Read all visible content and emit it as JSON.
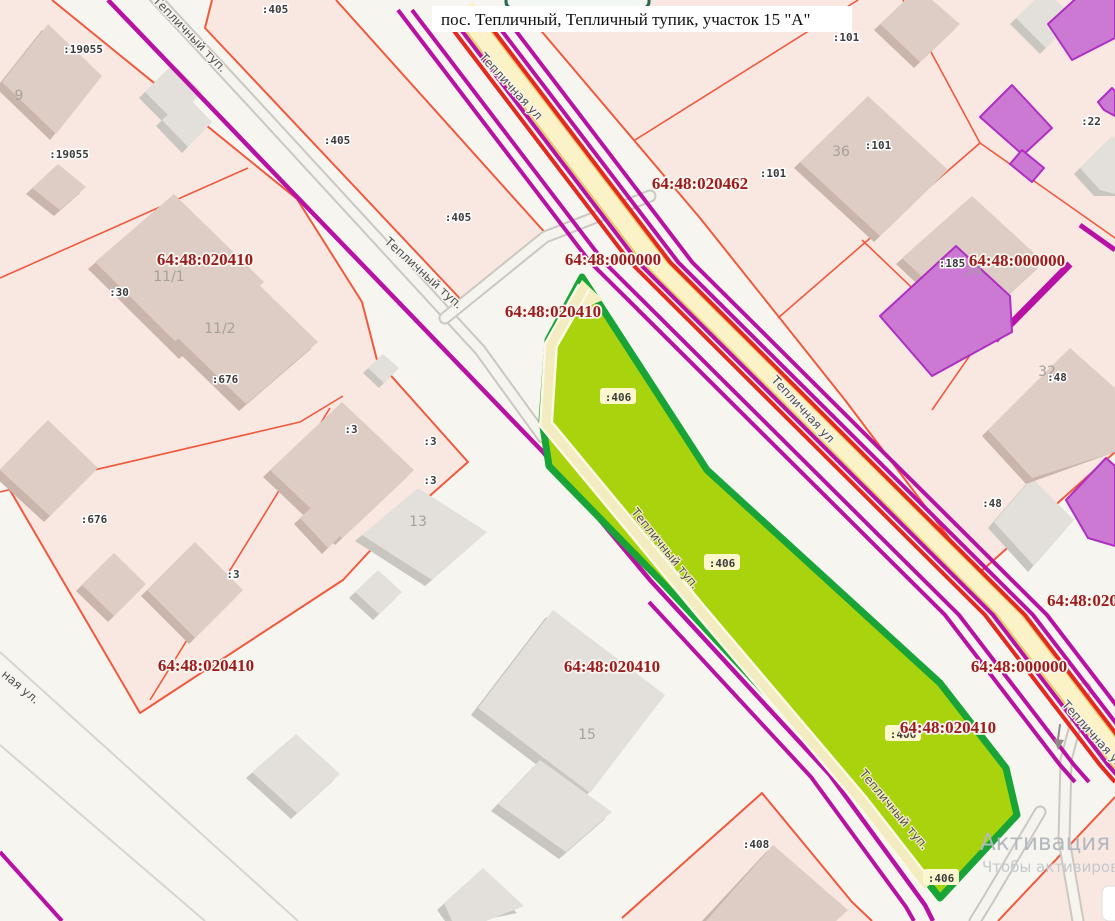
{
  "app": {
    "type": "public-cadastral-map"
  },
  "balloon": {
    "title": "пос. Тепличный, Тепличный тупик, участок 15 \"А\""
  },
  "watermark": {
    "line1": "Активация Win",
    "line2": "Чтобы активироват"
  },
  "colors": {
    "background": "#f7f5f0",
    "parcel_fill": "#f9e8e2",
    "parcel_border": "#f0593c",
    "quarter_label": "#9d1b1b",
    "road_magenta": "#b712a3",
    "road_red": "#e42a20",
    "road_yellow": "#fcf2c8",
    "selected_fill": "#a9d30d",
    "selected_border": "#18a437",
    "building_gray": "#e3e0dc",
    "building_brown": "#decdc5",
    "building_magenta": "#cb79d3"
  },
  "selected_parcel": {
    "number": ":406",
    "street": "Тепличный туп."
  },
  "quarter_labels": [
    {
      "t": "64:48:020410",
      "x": 205,
      "y": 265
    },
    {
      "t": "64:48:000000",
      "x": 613,
      "y": 265
    },
    {
      "t": "64:48:020410",
      "x": 553,
      "y": 317
    },
    {
      "t": "64:48:020462",
      "x": 700,
      "y": 189
    },
    {
      "t": "64:48:000000",
      "x": 1017,
      "y": 266
    },
    {
      "t": "64:48:020410",
      "x": 206,
      "y": 671
    },
    {
      "t": "64:48:020410",
      "x": 612,
      "y": 672
    },
    {
      "t": "64:48:000000",
      "x": 1019,
      "y": 672
    },
    {
      "t": "64:48:020410",
      "x": 948,
      "y": 733
    },
    {
      "t": "64:48:020",
      "x": 1047,
      "y": 606
    }
  ],
  "parcel_labels": [
    {
      "t": ":19055",
      "x": 83,
      "y": 53
    },
    {
      "t": ":19055",
      "x": 69,
      "y": 158
    },
    {
      "t": ":405",
      "x": 275,
      "y": 13
    },
    {
      "t": ":405",
      "x": 337,
      "y": 144
    },
    {
      "t": ":405",
      "x": 458,
      "y": 221
    },
    {
      "t": ":30",
      "x": 119,
      "y": 296
    },
    {
      "t": ":676",
      "x": 225,
      "y": 383
    },
    {
      "t": ":676",
      "x": 94,
      "y": 523
    },
    {
      "t": ":3",
      "x": 351,
      "y": 433
    },
    {
      "t": ":3",
      "x": 430,
      "y": 445
    },
    {
      "t": ":3",
      "x": 430,
      "y": 484
    },
    {
      "t": ":3",
      "x": 233,
      "y": 578
    },
    {
      "t": ":101",
      "x": 846,
      "y": 41
    },
    {
      "t": ":101",
      "x": 878,
      "y": 149
    },
    {
      "t": ":101",
      "x": 773,
      "y": 177
    },
    {
      "t": ":22",
      "x": 1091,
      "y": 125
    },
    {
      "t": ":185",
      "x": 952,
      "y": 267
    },
    {
      "t": ":48",
      "x": 1057,
      "y": 381
    },
    {
      "t": ":48",
      "x": 992,
      "y": 507
    },
    {
      "t": ":408",
      "x": 756,
      "y": 848
    }
  ],
  "selected_labels": [
    {
      "t": ":406",
      "x": 618,
      "y": 401
    },
    {
      "t": ":406",
      "x": 722,
      "y": 567
    },
    {
      "t": ":406",
      "x": 903,
      "y": 738
    },
    {
      "t": ":406",
      "x": 941,
      "y": 882
    }
  ],
  "house_labels": [
    {
      "t": "9",
      "x": 19,
      "y": 100
    },
    {
      "t": "11/1",
      "x": 169,
      "y": 281
    },
    {
      "t": "11/2",
      "x": 220,
      "y": 333
    },
    {
      "t": "13",
      "x": 418,
      "y": 526
    },
    {
      "t": "15",
      "x": 587,
      "y": 739
    },
    {
      "t": "36",
      "x": 841,
      "y": 156
    },
    {
      "t": "34",
      "x": 974,
      "y": 275
    },
    {
      "t": "32",
      "x": 1047,
      "y": 376
    }
  ],
  "street_labels": [
    {
      "t": "Тепличный туп.",
      "x": 187,
      "y": 37,
      "r": 46
    },
    {
      "t": "Тепличный туп.",
      "x": 421,
      "y": 276,
      "r": 42
    },
    {
      "t": "Тепличный туп.",
      "x": 662,
      "y": 551,
      "r": 51
    },
    {
      "t": "Тепличный туп.",
      "x": 891,
      "y": 812,
      "r": 50
    },
    {
      "t": "Тепличная ул",
      "x": 508,
      "y": 89,
      "r": 47
    },
    {
      "t": "Тепличная ул",
      "x": 800,
      "y": 412,
      "r": 47
    },
    {
      "t": "Тепличная ул",
      "x": 1090,
      "y": 737,
      "r": 48
    },
    {
      "t": "ная ул.",
      "x": 18,
      "y": 690,
      "r": 40
    }
  ]
}
